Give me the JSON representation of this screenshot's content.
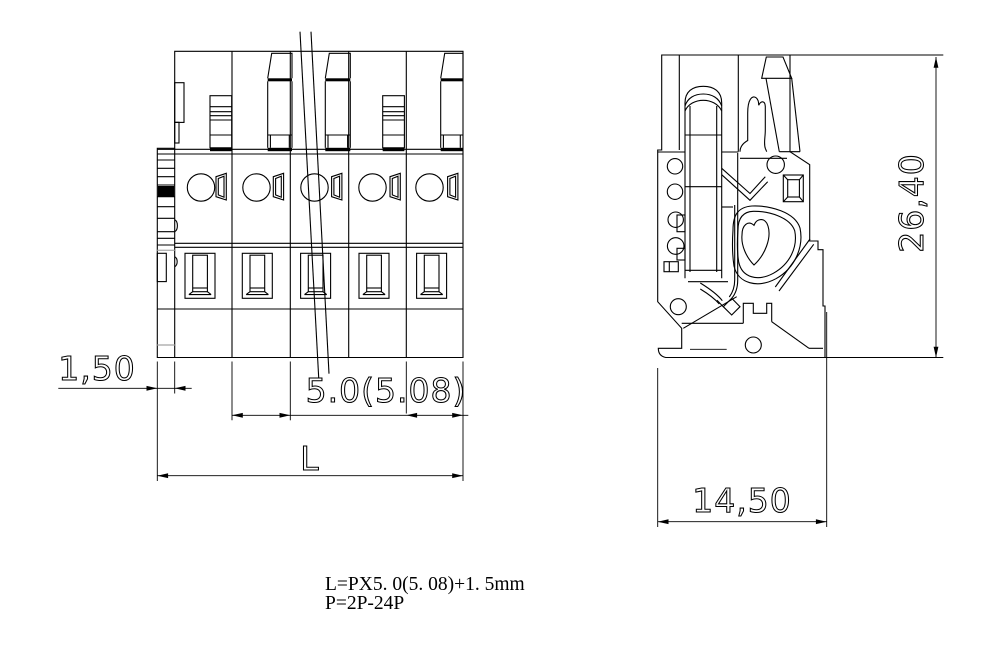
{
  "title": "terminal-block-connector-drawing",
  "views": {
    "front_view": {
      "name": "front-view",
      "positions_shown": 5
    },
    "side_view": {
      "name": "side-section-view"
    }
  },
  "dimensions": {
    "left_offset": "1,50",
    "pitch": "5.0(5.08)",
    "total_length_label": "L",
    "overall_height": "26,40",
    "overall_depth": "14,50"
  },
  "notes": {
    "line1": "L=PX5. 0(5. 08)+1. 5mm",
    "line2": "P=2P-24P"
  },
  "colors": {
    "line": "#000000",
    "background": "#ffffff",
    "construction_line": "#b3b3b3"
  }
}
